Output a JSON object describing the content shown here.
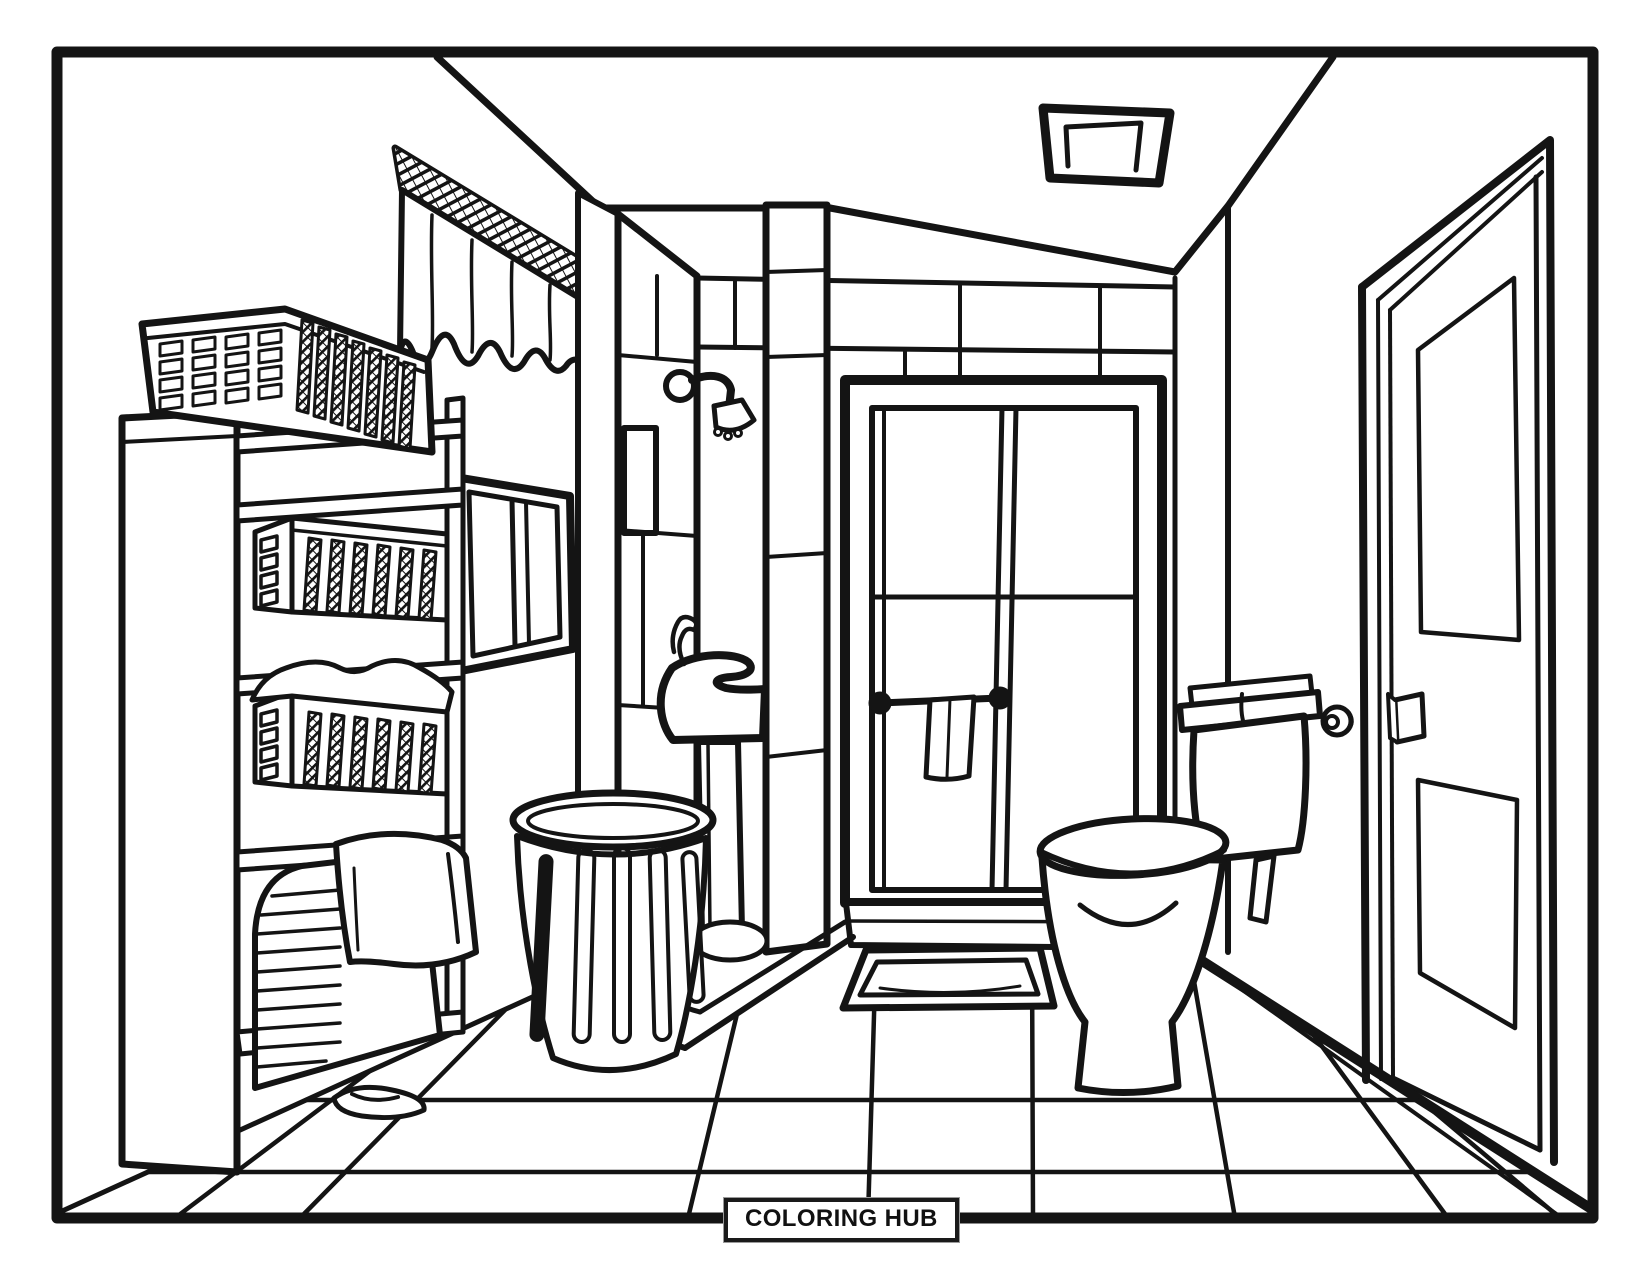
{
  "footer": {
    "brand": "COLORING HUB"
  },
  "palette": {
    "ink": "#141414",
    "paper": "#ffffff"
  },
  "scene": {
    "description": "black and white line-art coloring page of a bathroom interior in one-point perspective",
    "objects": [
      "curtain-valance",
      "wall-cabinet-window",
      "shelf-unit",
      "laundry-basket-top",
      "storage-basket-upper",
      "storage-basket-lower",
      "laundry-hamper",
      "draped-towel",
      "slipper",
      "tiled-partition",
      "tiled-pillar",
      "shower-arm",
      "shower-head",
      "pedestal-sink",
      "faucet",
      "trash-can",
      "shower-glass-door",
      "towel-bar",
      "hanging-towel",
      "bath-mat",
      "toilet",
      "toilet-tank",
      "toilet-paper-holder",
      "bathroom-door",
      "door-handle",
      "ceiling-vent",
      "tiled-floor",
      "baseboard"
    ]
  }
}
